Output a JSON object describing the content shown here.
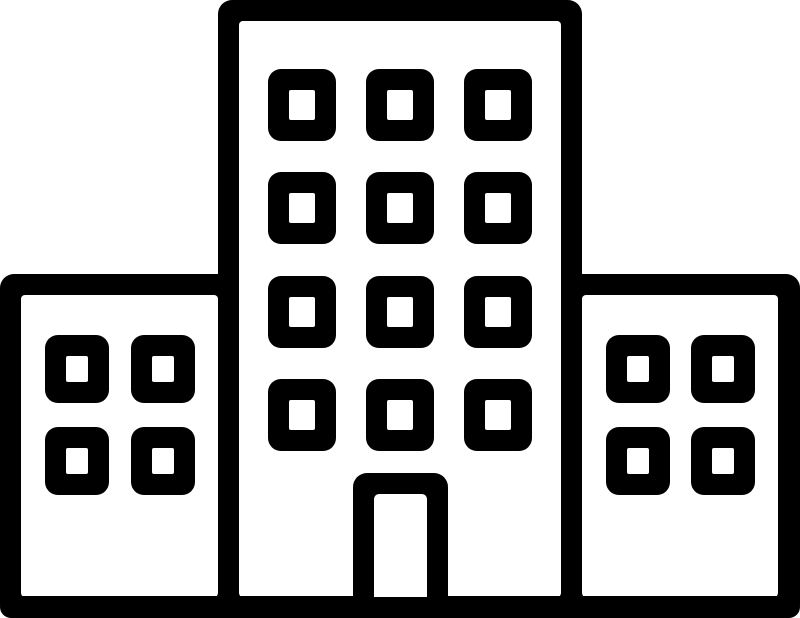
{
  "icon": {
    "name": "building-icon",
    "description": "Black outline icon of a building: tall center tower with twelve windows and a door, flanked by two lower wings with four windows each, standing on a ground line",
    "colors": {
      "ink": "#000000",
      "paper": "#ffffff"
    },
    "structure": {
      "center_tower": {
        "window_rows": 4,
        "window_cols": 3,
        "window_count": 12,
        "doors": 1
      },
      "left_wing": {
        "window_rows": 2,
        "window_cols": 2,
        "window_count": 4
      },
      "right_wing": {
        "window_rows": 2,
        "window_cols": 2,
        "window_count": 4
      },
      "ground_line": true
    }
  }
}
